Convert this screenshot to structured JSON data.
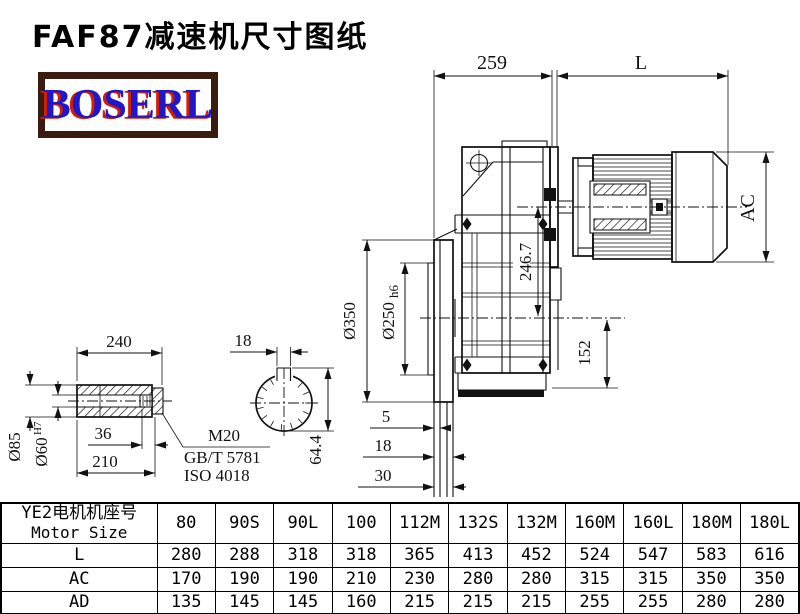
{
  "title": "FAF87减速机尺寸图纸",
  "logo": {
    "text": "BOSERL"
  },
  "colors": {
    "logo_border": "#3a1b10",
    "logo_text": "#2018c8",
    "logo_shadow": "#d41e04",
    "line": "#111111"
  },
  "drawing": {
    "dims": {
      "overall_width": "259",
      "motor_length": "L",
      "motor_od": "AC",
      "axis_height": "246.7",
      "base_height": "152",
      "flange_od": "Ø350",
      "spigot_od": "Ø250",
      "spigot_tol": "h6",
      "flange_step_a": "5",
      "flange_step_b": "18",
      "flange_step_c": "30",
      "shaft_length": "240",
      "keyway_width": "18",
      "shaft_od": "Ø85",
      "bore_dia": "Ø60",
      "bore_tol": "H7",
      "thread_depth": "36",
      "bore_depth": "210",
      "thread_spec": "M20",
      "thread_std_gb": "GB/T 5781",
      "thread_std_iso": "ISO 4018",
      "keyway_depth": "64.4"
    }
  },
  "table": {
    "header": {
      "line1": "YE2电机机座号",
      "line2": "Motor Size"
    },
    "columns": [
      "80",
      "90S",
      "90L",
      "100",
      "112M",
      "132S",
      "132M",
      "160M",
      "160L",
      "180M",
      "180L"
    ],
    "rows": [
      {
        "label": "L",
        "values": [
          "280",
          "288",
          "318",
          "318",
          "365",
          "413",
          "452",
          "524",
          "547",
          "583",
          "616"
        ]
      },
      {
        "label": "AC",
        "values": [
          "170",
          "190",
          "190",
          "210",
          "230",
          "280",
          "280",
          "315",
          "315",
          "350",
          "350"
        ]
      },
      {
        "label": "AD",
        "values": [
          "135",
          "145",
          "145",
          "160",
          "215",
          "215",
          "215",
          "255",
          "255",
          "280",
          "280"
        ]
      }
    ]
  }
}
